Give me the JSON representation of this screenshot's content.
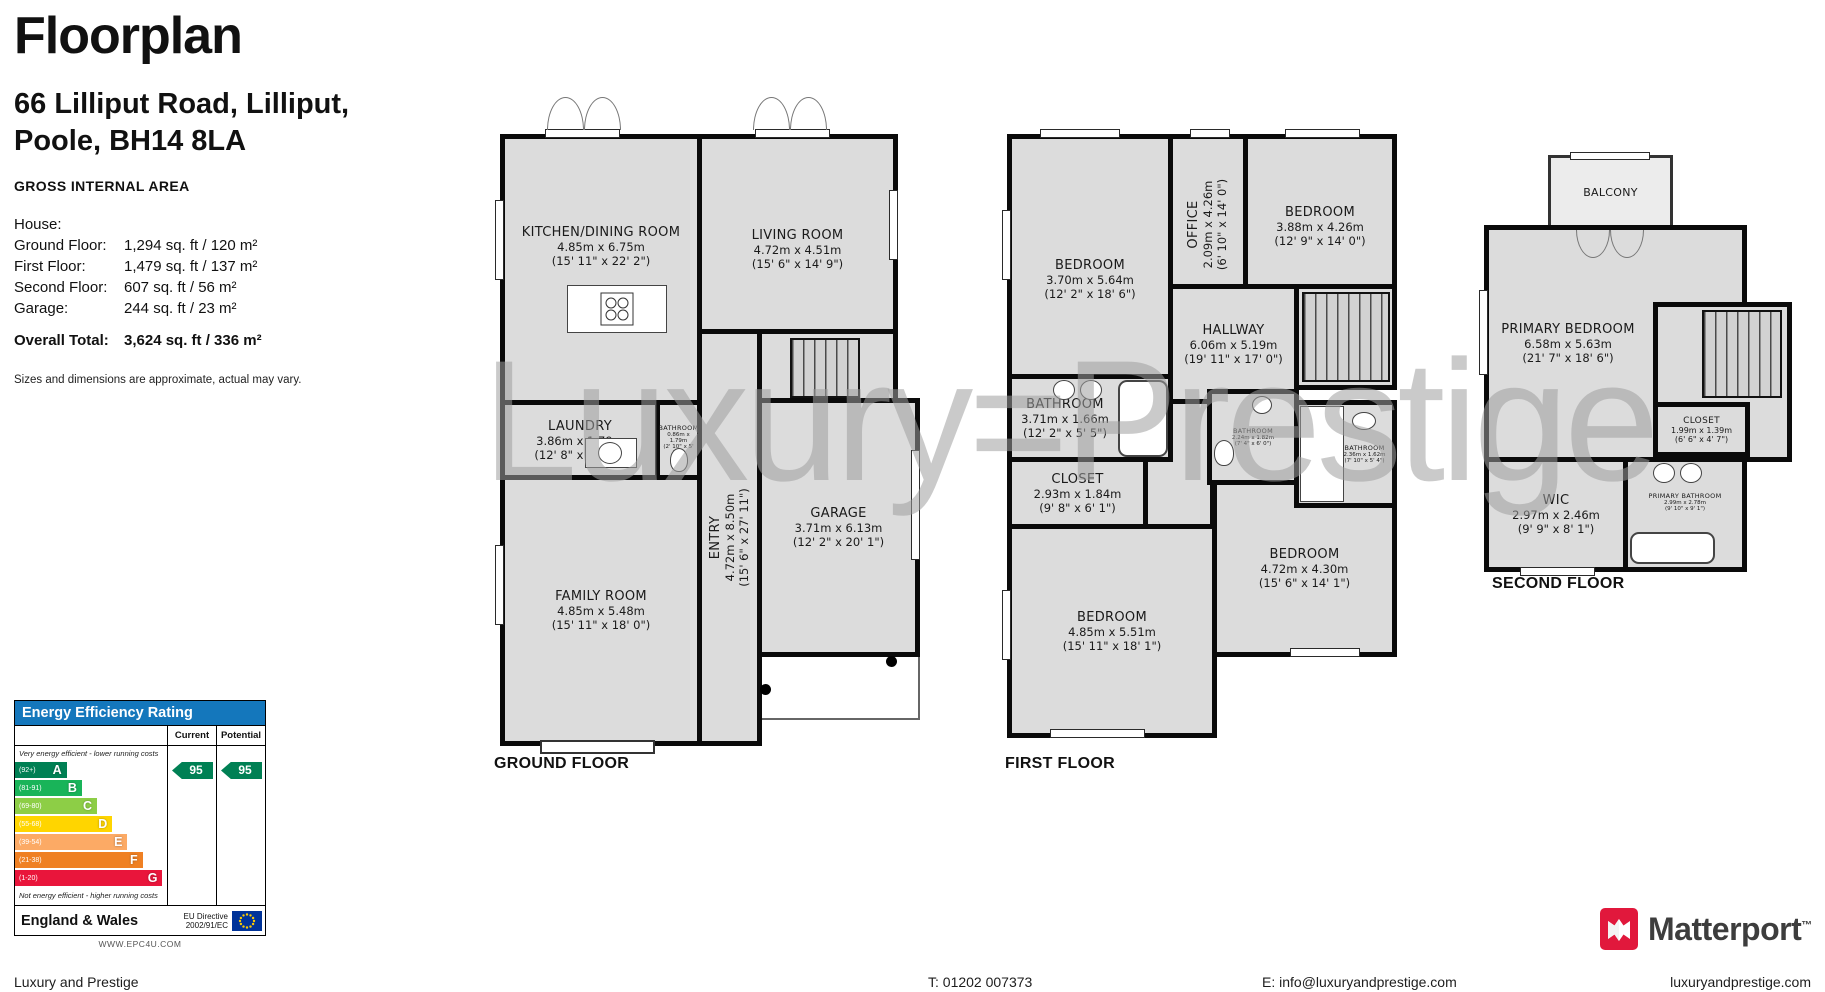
{
  "header": {
    "title": "Floorplan",
    "address_line1": "66 Lilliput Road, Lilliput,",
    "address_line2": "Poole, BH14 8LA"
  },
  "gia": {
    "heading": "GROSS INTERNAL AREA",
    "rows": [
      {
        "label": "House:",
        "value": ""
      },
      {
        "label": "Ground Floor:",
        "value": "1,294 sq. ft / 120 m²"
      },
      {
        "label": "First Floor:",
        "value": "1,479 sq. ft / 137 m²"
      },
      {
        "label": "Second Floor:",
        "value": "607 sq. ft / 56 m²"
      },
      {
        "label": "Garage:",
        "value": "244 sq. ft / 23 m²"
      }
    ],
    "total_label": "Overall Total:",
    "total_value": "3,624 sq. ft / 336 m²",
    "disclaimer": "Sizes and dimensions are approximate, actual may vary."
  },
  "epc": {
    "title": "Energy Efficiency Rating",
    "col_current": "Current",
    "col_potential": "Potential",
    "note_top": "Very energy efficient - lower running costs",
    "note_bottom": "Not energy efficient - higher running costs",
    "bands": [
      {
        "range": "(92+)",
        "letter": "A",
        "color": "#008054",
        "width_pct": 34
      },
      {
        "range": "(81-91)",
        "letter": "B",
        "color": "#19b459",
        "width_pct": 44
      },
      {
        "range": "(69-80)",
        "letter": "C",
        "color": "#8dce46",
        "width_pct": 54
      },
      {
        "range": "(55-68)",
        "letter": "D",
        "color": "#ffd500",
        "width_pct": 64
      },
      {
        "range": "(39-54)",
        "letter": "E",
        "color": "#fcaa65",
        "width_pct": 74
      },
      {
        "range": "(21-38)",
        "letter": "F",
        "color": "#ef8023",
        "width_pct": 84
      },
      {
        "range": "(1-20)",
        "letter": "G",
        "color": "#e9153b",
        "width_pct": 97
      }
    ],
    "current_value": "95",
    "potential_value": "95",
    "region": "England & Wales",
    "directive_line1": "EU Directive",
    "directive_line2": "2002/91/EC",
    "website": "WWW.EPC4U.COM"
  },
  "watermark": {
    "text": "Luxury=Prestige"
  },
  "floors": {
    "ground": {
      "label": "GROUND FLOOR",
      "rooms": {
        "kitchen": {
          "name": "KITCHEN/DINING ROOM",
          "m": "4.85m x 6.75m",
          "ft": "(15' 11\" x 22' 2\")"
        },
        "living": {
          "name": "LIVING ROOM",
          "m": "4.72m x 4.51m",
          "ft": "(15' 6\" x 14' 9\")"
        },
        "laundry": {
          "name": "LAUNDRY",
          "m": "3.86m x 1.79m",
          "ft": "(12' 8\" x 5' 10\")"
        },
        "bathroom": {
          "name": "BATHROOM",
          "m": "0.86m x 1.79m",
          "ft": "(2' 10\" x 5' 10\")"
        },
        "entry": {
          "name": "ENTRY",
          "m": "4.72m x 8.50m",
          "ft": "(15' 6\" x 27' 11\")"
        },
        "family": {
          "name": "FAMILY ROOM",
          "m": "4.85m x 5.48m",
          "ft": "(15' 11\" x 18' 0\")"
        },
        "garage": {
          "name": "GARAGE",
          "m": "3.71m x 6.13m",
          "ft": "(12' 2\" x 20' 1\")"
        }
      }
    },
    "first": {
      "label": "FIRST FLOOR",
      "rooms": {
        "bedroom1": {
          "name": "BEDROOM",
          "m": "3.70m x 5.64m",
          "ft": "(12' 2\" x 18' 6\")"
        },
        "office": {
          "name": "OFFICE",
          "m": "2.09m x 4.26m",
          "ft": "(6' 10\" x 14' 0\")"
        },
        "bedroom2": {
          "name": "BEDROOM",
          "m": "3.88m x 4.26m",
          "ft": "(12' 9\" x 14' 0\")"
        },
        "hallway": {
          "name": "HALLWAY",
          "m": "6.06m x 5.19m",
          "ft": "(19' 11\" x 17' 0\")"
        },
        "bathroom1": {
          "name": "BATHROOM",
          "m": "3.71m x 1.66m",
          "ft": "(12' 2\" x 5' 5\")"
        },
        "closet": {
          "name": "CLOSET",
          "m": "2.93m x 1.84m",
          "ft": "(9' 8\" x 6' 1\")"
        },
        "bathroom2": {
          "name": "BATHROOM",
          "m": "2.24m x 1.82m",
          "ft": "(7' 4\" x 6' 0\")"
        },
        "bathroom3": {
          "name": "BATHROOM",
          "m": "2.36m x 1.62m",
          "ft": "(7' 10\" x 5' 4\")"
        },
        "bedroom3": {
          "name": "BEDROOM",
          "m": "4.72m x 4.30m",
          "ft": "(15' 6\" x 14' 1\")"
        },
        "bedroom4": {
          "name": "BEDROOM",
          "m": "4.85m x 5.51m",
          "ft": "(15' 11\" x 18' 1\")"
        }
      }
    },
    "second": {
      "label": "SECOND FLOOR",
      "rooms": {
        "balcony": {
          "name": "BALCONY"
        },
        "primary": {
          "name": "PRIMARY BEDROOM",
          "m": "6.58m x 5.63m",
          "ft": "(21' 7\" x 18' 6\")"
        },
        "closet": {
          "name": "CLOSET",
          "m": "1.99m x 1.39m",
          "ft": "(6' 6\" x 4' 7\")"
        },
        "wic": {
          "name": "WIC",
          "m": "2.97m x 2.46m",
          "ft": "(9' 9\" x 8' 1\")"
        },
        "primary_bathroom": {
          "name": "PRIMARY BATHROOM",
          "m": "2.99m x 2.78m",
          "ft": "(9' 10\" x 9' 1\")"
        }
      }
    }
  },
  "branding": {
    "matterport": "Matterport",
    "trademark": "™"
  },
  "footer": {
    "company": "Luxury and Prestige",
    "phone": "T: 01202 007373",
    "email": "E: info@luxuryandprestige.com",
    "website": "luxuryandprestige.com"
  }
}
